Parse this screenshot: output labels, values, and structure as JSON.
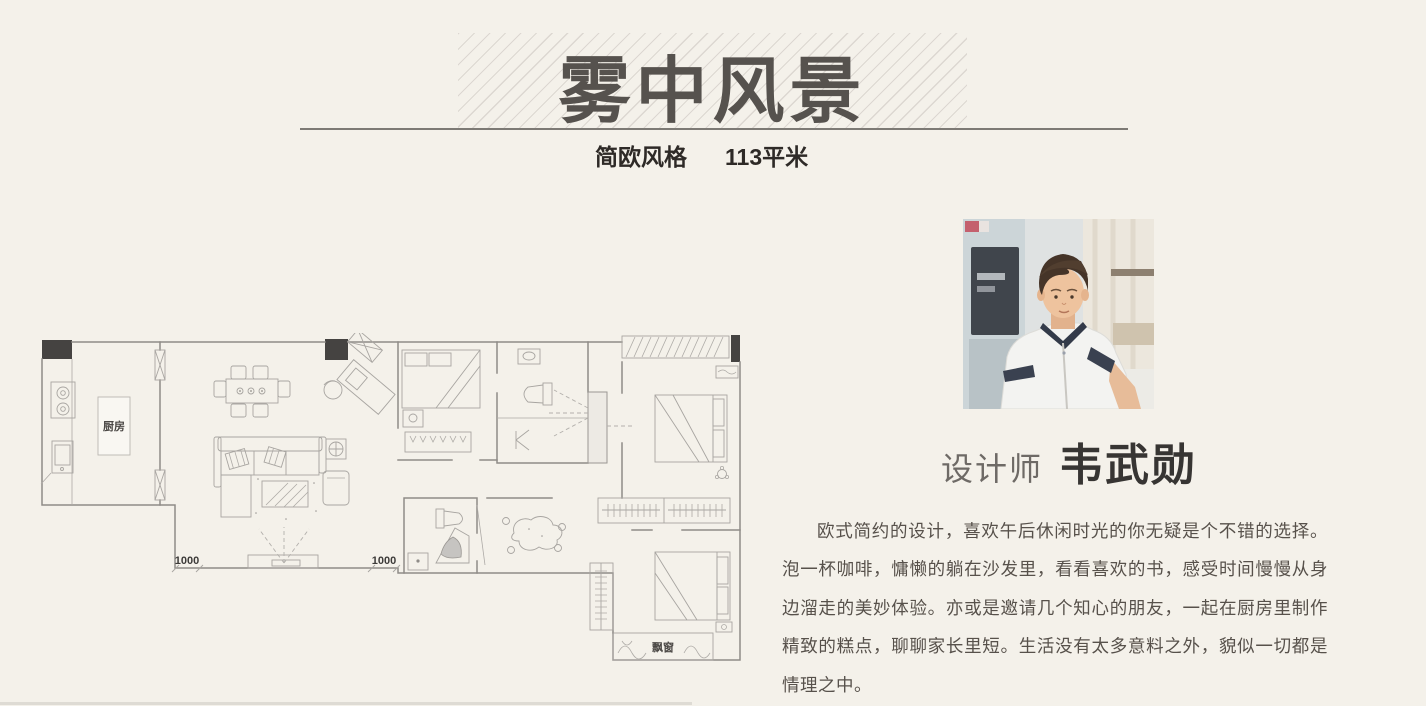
{
  "header": {
    "title": "雾中风景",
    "style_label": "简欧风格",
    "area_label": "113平米"
  },
  "floor_plan": {
    "kitchen_label": "厨房",
    "bay_window_label": "飘窗",
    "dim_left": "1000",
    "dim_right": "1000"
  },
  "designer": {
    "role_label": "设计师",
    "name": "韦武勋"
  },
  "description": {
    "text": "欧式简约的设计，喜欢午后休闲时光的你无疑是个不错的选择。泡一杯咖啡，慵懒的躺在沙发里，看看喜欢的书，感受时间慢慢从身边溜走的美妙体验。亦或是邀请几个知心的朋友，一起在厨房里制作精致的糕点，聊聊家长里短。生活没有太多意料之外，貌似一切都是情理之中。"
  },
  "colors": {
    "background": "#f4f1ea",
    "title_text": "#56524e",
    "stripe": "#dcd7d1",
    "rule": "#7d7a75",
    "body_text": "#57514b",
    "name_text": "#373533"
  }
}
